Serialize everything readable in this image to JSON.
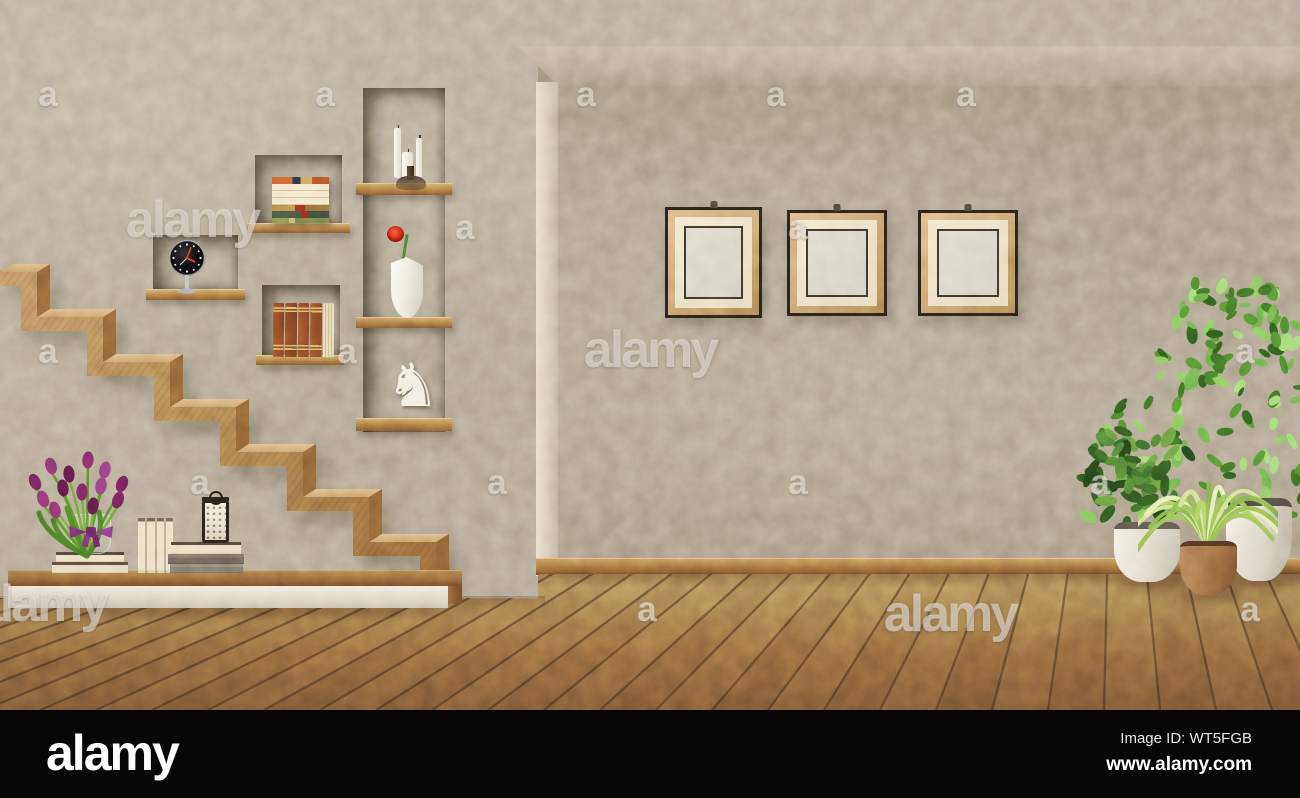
{
  "scene": {
    "description": "Retro living room 3D render: wooden zigzag staircase, wall niches with ornaments, three empty picture frames, potted plants and hardwood floor",
    "objects": [
      "staircase",
      "wall-niche-clock",
      "wall-niche-books-horizontal",
      "wall-niche-books-vertical",
      "tall-niche-candelabra",
      "tall-niche-vase-rose",
      "tall-niche-chess-knight",
      "picture-frame",
      "picture-frame",
      "picture-frame",
      "bench-with-tulips-books-lantern",
      "potted-plants",
      "hardwood-floor"
    ],
    "colors": {
      "wall": "#b4aa96",
      "recess_wall": "#aba08b",
      "niche_wood": "#5e3f28",
      "shelf_wood": "#aa7a44",
      "stair_wood": "#b0855a",
      "floor_wood": "#93683f",
      "baseboard": "#a4743f",
      "frame_wood": "#c79e6e",
      "frame_mat": "#ece0c3",
      "bench_base": "#e6e0d1",
      "tulip_purple": "#7c2a66",
      "rose_red": "#d02c1c",
      "foliage_green": "#5a9638",
      "footer_background": "#060606"
    }
  },
  "watermarks": {
    "brand_text": "alamy",
    "letter": "a",
    "large": [
      {
        "x": 192,
        "y": 220
      },
      {
        "x": 650,
        "y": 350
      },
      {
        "x": 950,
        "y": 614
      },
      {
        "x": 40,
        "y": 604
      }
    ],
    "small": [
      {
        "x": 48,
        "y": 95
      },
      {
        "x": 325,
        "y": 95
      },
      {
        "x": 586,
        "y": 95
      },
      {
        "x": 776,
        "y": 95
      },
      {
        "x": 966,
        "y": 95
      },
      {
        "x": 465,
        "y": 228
      },
      {
        "x": 798,
        "y": 228
      },
      {
        "x": 48,
        "y": 352
      },
      {
        "x": 347,
        "y": 352
      },
      {
        "x": 1245,
        "y": 352
      },
      {
        "x": 200,
        "y": 483
      },
      {
        "x": 497,
        "y": 483
      },
      {
        "x": 798,
        "y": 483
      },
      {
        "x": 1100,
        "y": 483
      },
      {
        "x": 647,
        "y": 610
      },
      {
        "x": 1250,
        "y": 610
      }
    ]
  },
  "footer": {
    "logo_text": "alamy",
    "image_id": "Image ID: WT5FGB",
    "website": "www.alamy.com"
  }
}
